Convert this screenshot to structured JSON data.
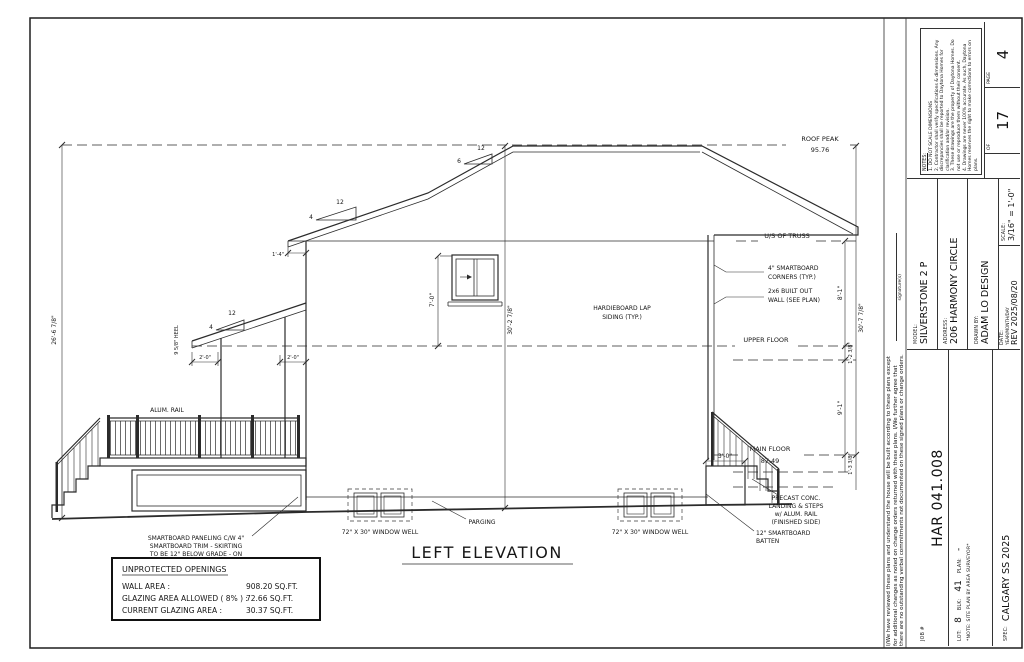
{
  "title_block": {
    "job_label": "JOB #",
    "job_value": "HAR 041.008",
    "lot_label": "LOT:",
    "lot_value": "8",
    "blk_label": "BLK:",
    "blk_value": "41",
    "plan_label": "PLAN:",
    "plan_value": "-",
    "site_note": "*NOTE: SITE PLAN BY AREA SURVEYOR*",
    "spec_label": "SPEC:",
    "spec_value": "CALGARY SS 2025",
    "model_label": "MODEL:",
    "model_value": "SILVERSTONE 2 P",
    "address_label": "ADDRESS:",
    "address_value": "206 HARMONY CIRCLE",
    "drawn_label": "DRAWN BY:",
    "drawn_value": "ADAM LO DESIGN",
    "date_label": "DATE:",
    "date_format": "YEAR/MONTH/DAY",
    "date_value": "REV 2025/08/20",
    "scale_label": "SCALE:",
    "scale_value": "3/16\" = 1'-0\"",
    "page_label": "PAGE",
    "page_value": "4",
    "of_label": "OF",
    "of_value": "17",
    "notes_title": "NOTES:",
    "note_1": "1. DO NOT SCALE DIMENSIONS",
    "note_2": "2. Contractor shall verify specifications & dimensions. Any discrepancies shall be reported to Daytona Homes for clarification and/or revision.",
    "note_3": "3. These drawings are the property of Daytona Homes. Do not use or reproduce them without their consent.",
    "note_4": "4. Drawings are never 100% accurate. As such, Daytona Homes reserves the right to make corrections to errors on plans."
  },
  "disclaimer": {
    "line1": "I/We have reviewed these plans and understand the house will be built according to these plans except",
    "line2": "for additional changes as noted on change orders returned with these plans. I/We further agree that",
    "line3": "there are no outstanding verbal commitments not documented on these signed plans or change orders.",
    "signature_label": "signature(s)"
  },
  "drawing": {
    "title": "LEFT ELEVATION",
    "roof_peak": "ROOF PEAK",
    "roof_peak_elev": "95.76",
    "us_truss": "U/S OF TRUSS",
    "upper_floor": "UPPER FLOOR",
    "main_floor": "MAIN FLOOR",
    "main_floor_elev": "87.49",
    "dim_overall_left": "26'-6 7/8\"",
    "dim_center": "30'-2 7/8\"",
    "dim_overall_right": "30'-7 7/8\"",
    "dim_upper_storey": "8'-1\"",
    "dim_upper_floor": "1'-2 3/8\"",
    "dim_main_storey": "9'-1\"",
    "dim_main_floor": "1'-3 3/8\"",
    "dim_window": "7'-0\"",
    "dim_eave": "1'-4\"",
    "dim_overhang_l": "2'-0\"",
    "dim_overhang_r": "2'-0\"",
    "dim_landing": "3'-0\"",
    "heel": "9 5/8\" HEEL",
    "pitch_run": "12",
    "pitch_4": "4",
    "pitch_6": "6",
    "pitch_porch": "4",
    "label_corners_1": "4\" SMARTBOARD",
    "label_corners_2": "CORNERS (TYP.)",
    "label_builtout_1": "2x6 BUILT OUT",
    "label_builtout_2": "WALL (SEE PLAN)",
    "label_siding_1": "HARDIEBOARD LAP",
    "label_siding_2": "SIDING (TYP.)",
    "label_alum_rail": "ALUM. RAIL",
    "label_skirting_1": "SMARTBOARD PANELING C/W 4\"",
    "label_skirting_2": "SMARTBOARD TRIM - SKIRTING",
    "label_skirting_3": "TO BE 12\" BELOW GRADE - ON",
    "label_skirting_4": "SITE TO SUIT",
    "label_parging": "PARGING",
    "label_well": "72\" X 30\" WINDOW WELL",
    "label_precast_1": "PRECAST CONC.",
    "label_precast_2": "LANDING & STEPS",
    "label_precast_3": "w/ ALUM. RAIL",
    "label_precast_4": "(FINISHED SIDE)",
    "label_batten_1": "12\" SMARTBOARD",
    "label_batten_2": "BATTEN"
  },
  "openings": {
    "title": "UNPROTECTED OPENINGS",
    "row1_label": "WALL AREA :",
    "row1_value": "908.20 SQ.FT.",
    "row2_label": "GLAZING AREA ALLOWED ( 8% ) :",
    "row2_value": "72.66 SQ.FT.",
    "row3_label": "CURRENT GLAZING AREA :",
    "row3_value": "30.37 SQ.FT."
  }
}
